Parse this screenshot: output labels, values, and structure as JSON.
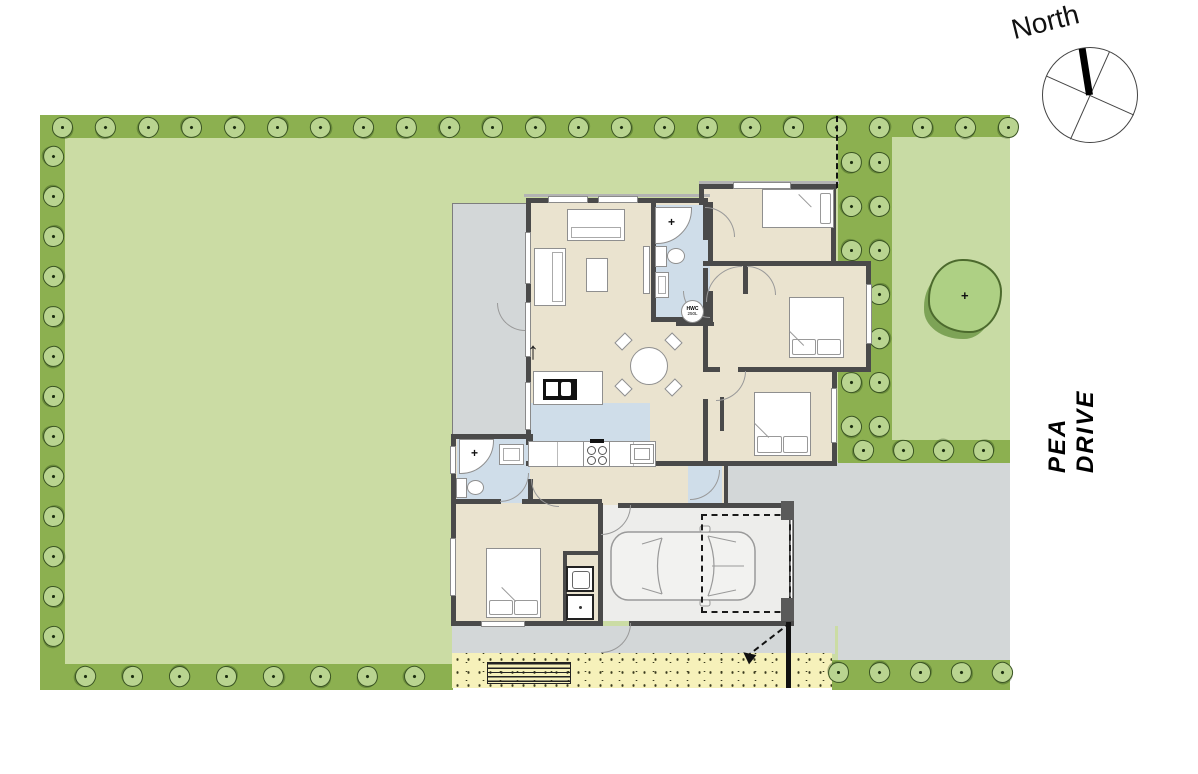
{
  "labels": {
    "compass_north": "North",
    "street_name": "PEA DRIVE",
    "hwc_line1": "HWC",
    "hwc_line2": "250L",
    "cross_mark": "+",
    "north_arrow": "↑"
  },
  "colors": {
    "lawn": "#cbdca4",
    "hedge": "#8cb050",
    "bush_fill": "#b9d490",
    "bush_outline": "#3a5423",
    "garden": "#c8dba4",
    "paving": "#d3d7d8",
    "sand": "#f6f1ba",
    "floor": "#eae3cf",
    "wet_floor": "#cfdde9",
    "garage_floor": "#ededeb",
    "wall": "#4a4a4a",
    "furniture_outline": "#8f8f8f",
    "tree_fill": "#aed084",
    "tree_shadow": "#7da356",
    "line_dark": "#111111"
  }
}
